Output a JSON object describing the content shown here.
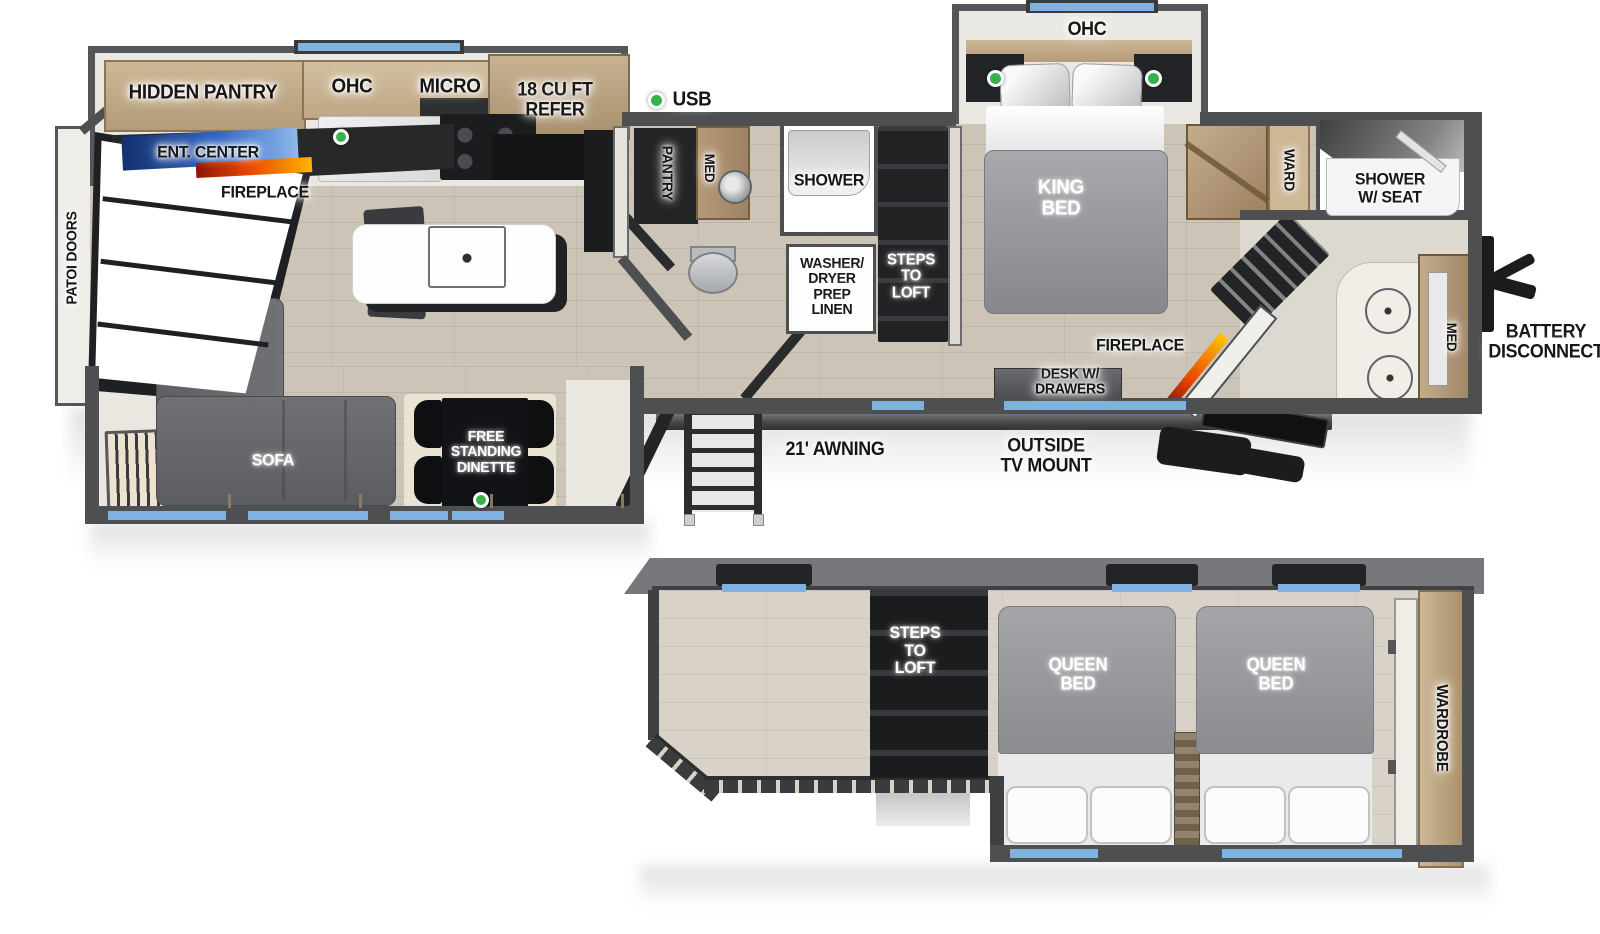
{
  "colors": {
    "wall_gray": "#4e4f51",
    "window_blue": "#7fb2e0",
    "usb_green": "#35b34a",
    "cabinet_wood": "#c0a884",
    "mattress_gray": "#97989b",
    "fireplace_orange": "#ff6a00",
    "tv_blue": "#2f64c4"
  },
  "main_floor": {
    "slide_kitchen": {
      "hidden_pantry": "HIDDEN PANTRY",
      "ohc": "OHC",
      "micro": "MICRO",
      "refer": "18 CU FT\nREFER"
    },
    "living": {
      "ent_center": "ENT. CENTER",
      "fireplace": "FIREPLACE",
      "patio_doors": "PATOI DOORS",
      "sofa_chaise": "SOFA",
      "sofa_main": "SOFA",
      "dinette": "FREE\nSTANDING\nDINETTE",
      "usb": "USB"
    },
    "bath_mid": {
      "pantry": "PANTRY",
      "med": "MED",
      "shower": "SHOWER",
      "washer_dryer": "WASHER/\nDRYER\nPREP\nLINEN",
      "steps_to_loft": "STEPS\nTO\nLOFT"
    },
    "bedroom": {
      "ohc": "OHC",
      "king_bed": "KING\nBED",
      "ward": "WARD",
      "fireplace": "FIREPLACE",
      "desk": "DESK W/\nDRAWERS"
    },
    "bath_front": {
      "shower_w_seat": "SHOWER\nW/ SEAT",
      "med": "MED"
    },
    "exterior": {
      "battery_disconnect": "BATTERY\nDISCONNECT",
      "awning": "21' AWNING",
      "tv_mount": "OUTSIDE\nTV MOUNT"
    }
  },
  "loft": {
    "steps_to_loft": "STEPS\nTO\nLOFT",
    "queen_bed_1": "QUEEN\nBED",
    "queen_bed_2": "QUEEN\nBED",
    "wardrobe": "WARDROBE"
  }
}
